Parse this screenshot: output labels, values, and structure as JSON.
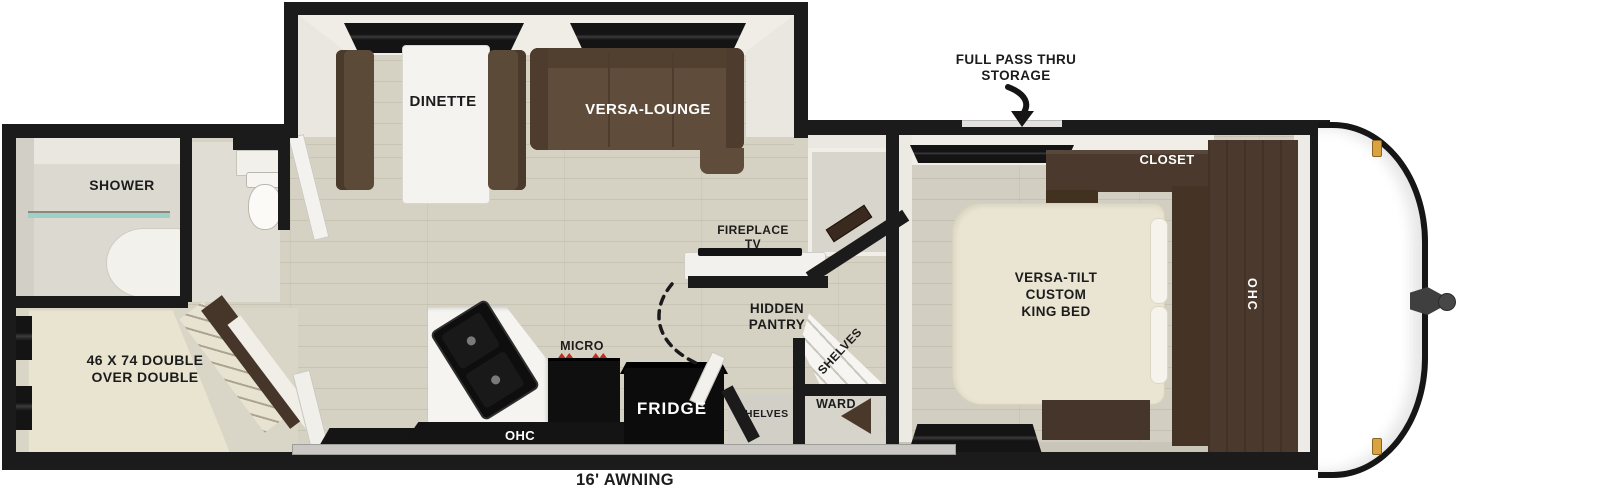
{
  "title": "Travel trailer floorplan",
  "colors": {
    "wall": "#1b1b1b",
    "floor": "#d6d2c3",
    "bedroom_floor": "#d2cec1",
    "sofa_brown": "#5f4c3a",
    "cabinet_brown": "#4a392c",
    "mattress_cream": "#eae5d2",
    "appliance_black": "#101010",
    "shower_glass_teal": "#9fd0c6",
    "marker_light_gold": "#d9a43f",
    "micro_accent_red": "#c42a21",
    "awning_gray": "#c9c8c4"
  },
  "labels": {
    "full_pass_thru_storage": [
      "FULL PASS THRU",
      "STORAGE"
    ],
    "dinette": "DINETTE",
    "versa_lounge": "VERSA-LOUNGE",
    "closet": "CLOSET",
    "shower": "SHOWER",
    "fireplace_tv": [
      "FIREPLACE",
      "TV"
    ],
    "king_bed": [
      "VERSA-TILT",
      "CUSTOM",
      "KING BED"
    ],
    "ohc_bedroom": "OHC",
    "hidden_pantry": [
      "HIDDEN",
      "PANTRY"
    ],
    "shelves_corner": "SHELVES",
    "bunk": [
      "46 X 74 DOUBLE",
      "OVER DOUBLE"
    ],
    "micro": "MICRO",
    "ohc_kitchen": "OHC",
    "fridge": "FRIDGE",
    "shelves_hall": "SHELVES",
    "ward": "WARD",
    "awning": "16' AWNING"
  }
}
